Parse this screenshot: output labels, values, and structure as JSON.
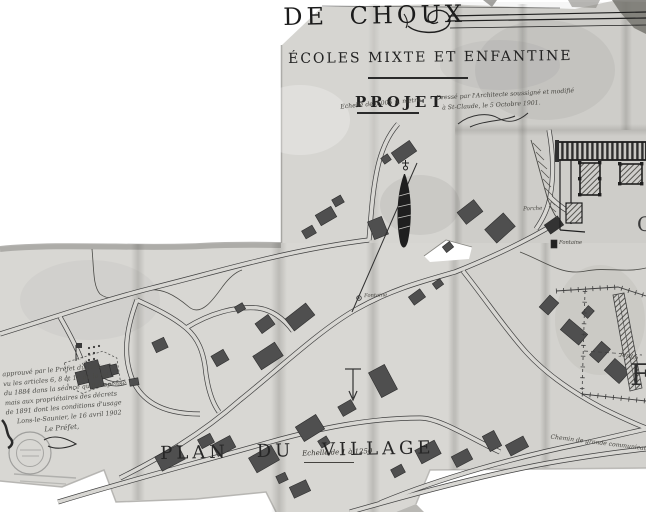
{
  "photo": {
    "background": "#ffffff",
    "paper_color": "#d8d7d3",
    "ink_color": "#3a3a3a",
    "building_color": "#4f4f4f"
  },
  "header": {
    "commune_title_fragment": "DE CHOUX",
    "subtitle": "ÉCOLES MIXTE ET ENFANTINE",
    "project_label": "PROJET",
    "project_scale_note": "Echelle de 0,005 p. mètre",
    "architect_note_line1": "Dressé par l'Architecte soussigné et modifié",
    "architect_note_line2": "à St-Claude, le 5 Octobre 1901."
  },
  "plan": {
    "title": "PLAN DU VILLAGE",
    "scale_note": "Echelle de 1 à 1250",
    "road_label": "Chemin de grande communication N°",
    "labels": {
      "porche": "Porche",
      "fontaine_school": "Fontaine",
      "fontaine_village": "Fontaine",
      "jardin": "Jardin"
    },
    "edge_letter_fragments": [
      "F",
      "C"
    ]
  },
  "approval": {
    "lines": [
      "approuvé par le Préfet du Jura",
      "vu les articles 6, 8 et 10 de la loi",
      "du 1884 dans la séance qu'il dispense",
      "mais aux propriétaires des décrets",
      "de 1891 dont les conditions d'usage",
      "Lons-le-Saunier, le 16 avril 1902",
      "Le Préfet,"
    ]
  }
}
